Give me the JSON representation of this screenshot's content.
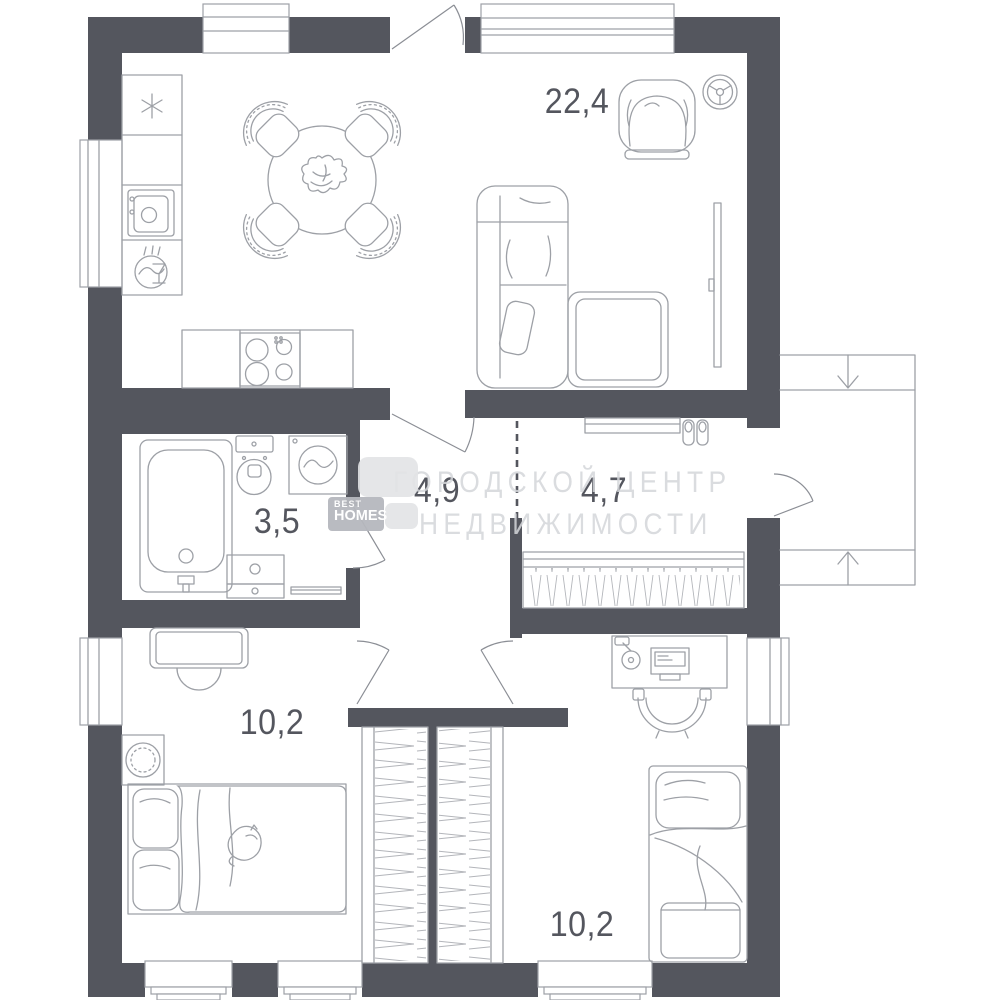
{
  "plan": {
    "watermark": {
      "line1": "ГОРОДСКОЙ ЦЕНТР",
      "line2": "НЕДВИЖИМОСТИ"
    },
    "logo": {
      "top": "BEST",
      "bottom": "HOMES"
    },
    "rooms": {
      "living_kitchen": {
        "label": "22,4"
      },
      "hall": {
        "label": "4,9"
      },
      "entry_corridor": {
        "label": "4,7"
      },
      "bathroom": {
        "label": "3,5"
      },
      "bedroom_left": {
        "label": "10,2"
      },
      "bedroom_right": {
        "label": "10,2"
      }
    },
    "colors": {
      "wall": "#54565e",
      "line": "#9da0a6",
      "watermark": "#d4d6da"
    }
  }
}
